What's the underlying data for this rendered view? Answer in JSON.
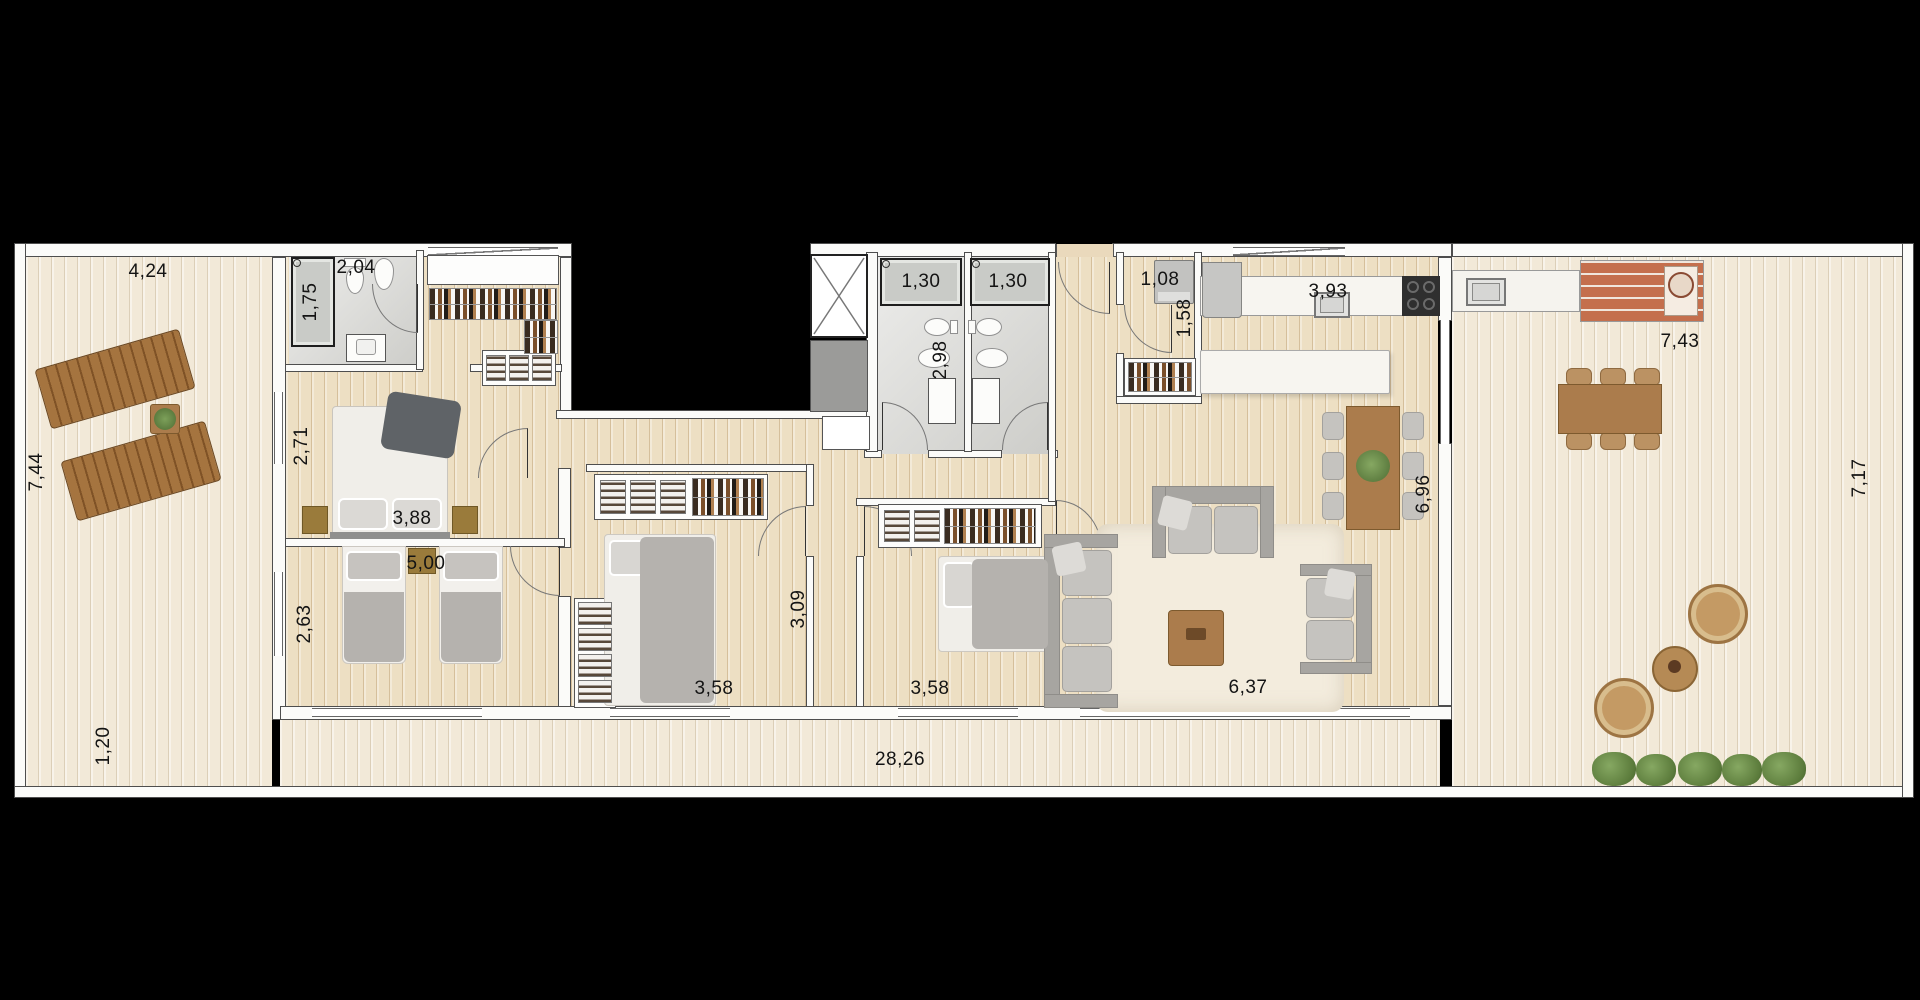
{
  "scene": "residential-apartment-floor-plan-top-view",
  "background": "#000000",
  "dimension_labels": {
    "terrace_left_width": "4,24",
    "terrace_left_depth": "7,44",
    "balcony_depth": "1,20",
    "balcony_length": "28,26",
    "ensuite_shower_width": "1,75",
    "ensuite_width": "2,04",
    "master_bedroom_depth": "2,71",
    "master_bedroom_width": "3,88",
    "twin_bedroom_width": "5,00",
    "twin_bedroom_depth": "2,63",
    "bedroom3_width": "3,58",
    "bedroom3_depth": "3,09",
    "bedroom4_width": "3,58",
    "bathrooms_depth": "2,98",
    "bathroom_left_shower_width": "1,30",
    "bathroom_right_shower_width": "1,30",
    "laundry_width": "1,08",
    "laundry_depth": "1,58",
    "kitchen_counter_width": "3,93",
    "living_dining_depth": "6,96",
    "living_width": "6,37",
    "terrace_right_bbq_width": "7,43",
    "terrace_right_depth": "7,17"
  },
  "palette": {
    "deck_wood": "#f2e9d8",
    "indoor_wood": "#eddfc3",
    "bathroom_tile": "#d8d8d4",
    "wall": "#fbfbf9",
    "line": "#4e4e4e",
    "furniture_wood": "#ab7c4c",
    "fabric_grey": "#c5c3bf",
    "rug": "#f3ecdd",
    "plant_green": "#5c7c3c",
    "brick": "#c46f4d",
    "background": "#000000"
  }
}
